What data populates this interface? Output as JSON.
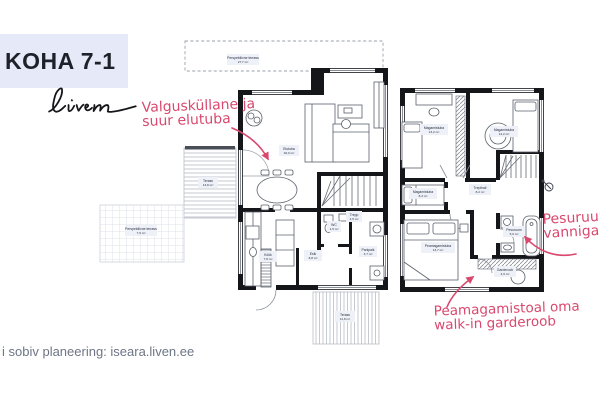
{
  "header": {
    "title": "KOHA 7-1",
    "logo": "Liven"
  },
  "annotations": {
    "living": {
      "line1": "Valgusküllane ja",
      "line2": "suur elutuba"
    },
    "bath": {
      "line1": "Pesuruum",
      "line2": "vanniga"
    },
    "wardrobe": {
      "line1": "Peamagamistoal oma",
      "line2": "walk-in garderoob"
    }
  },
  "footer": {
    "text": "i sobiv planeering: iseara.liven.ee"
  },
  "colors": {
    "accent_pink": "#d9486e",
    "header_box": "#e6e9f7",
    "wall": "#15161a",
    "label_chip": "#eef1f8",
    "footer_text": "#6d7585"
  },
  "plans": {
    "floor1": {
      "rooms": [
        {
          "name": "Perspektiivne terrass",
          "area": "27,7 m²"
        },
        {
          "name": "Elutuba",
          "area": "40,0 m²"
        },
        {
          "name": "Terass",
          "area": "13,8 m²"
        },
        {
          "name": "Perspektiivne terrass",
          "area": "7,9 m²"
        },
        {
          "name": "Köök",
          "area": "7,8 m²"
        },
        {
          "name": "Esik",
          "area": "8,8 m²"
        },
        {
          "name": "WC",
          "area": "1,5 m²"
        },
        {
          "name": "Trepp",
          "area": "4,5 m²"
        },
        {
          "name": "Panipaik",
          "area": "3,7 m²"
        },
        {
          "name": "Terass",
          "area": "11,8 m²"
        }
      ]
    },
    "floor2": {
      "rooms": [
        {
          "name": "Magamistuba",
          "area": "13,2 m²"
        },
        {
          "name": "Magamistuba",
          "area": "12,2 m²"
        },
        {
          "name": "Magamistuba",
          "area": "8,3 m²"
        },
        {
          "name": "Trepihall",
          "area": "8,2 m²"
        },
        {
          "name": "Peamagamistuba",
          "area": "13,7 m²"
        },
        {
          "name": "Pesuruum",
          "area": "5,0 m²"
        },
        {
          "name": "Garderoob",
          "area": "4,6 m²"
        }
      ]
    }
  }
}
